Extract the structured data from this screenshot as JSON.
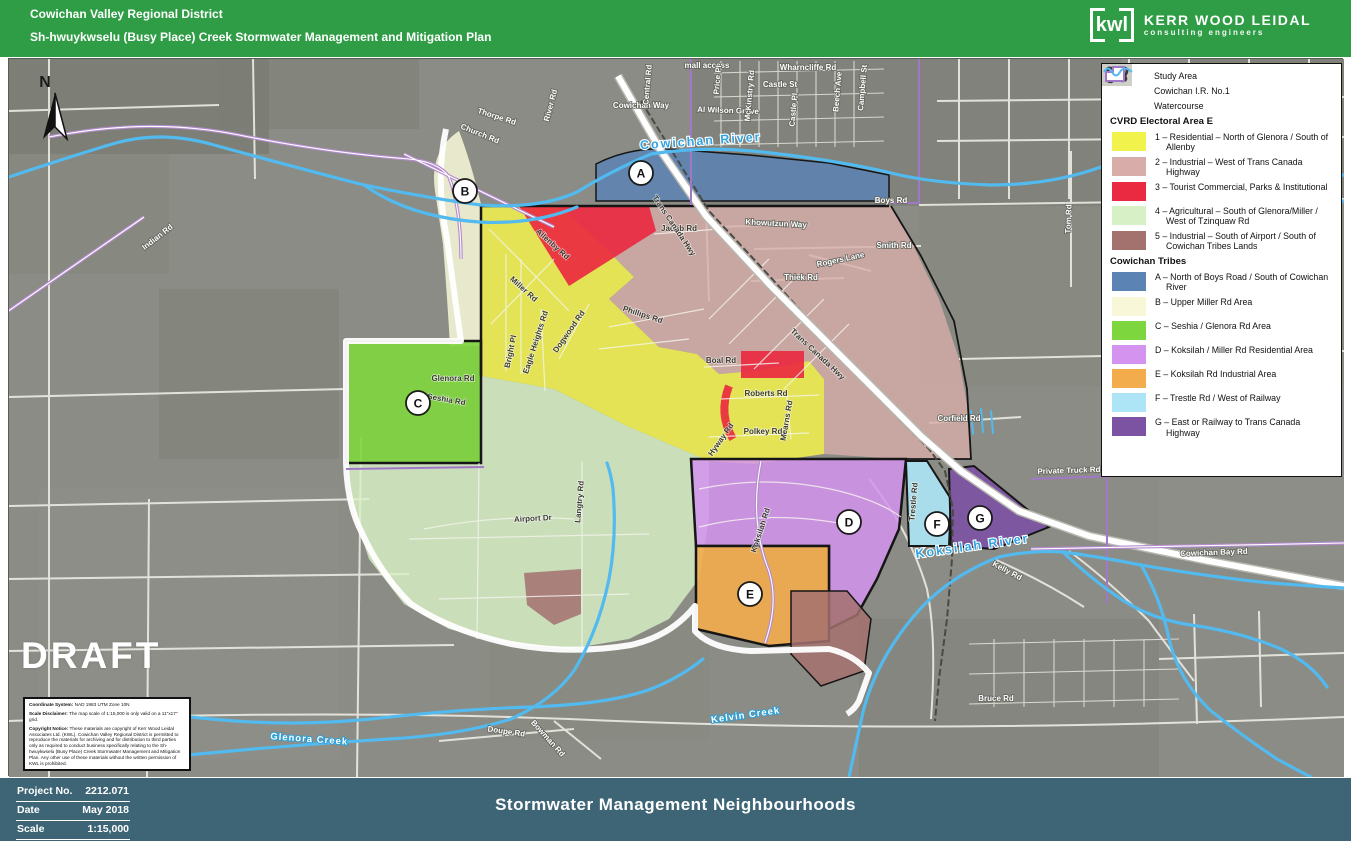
{
  "colors": {
    "header_green": "#2F9D45",
    "footer_slate": "#3D6576",
    "map_bg": "#8B8C85",
    "water": "#52BAEF",
    "road_white": "#F2F2EC",
    "ir_purple": "#A178C8",
    "study_outline": "#161616"
  },
  "header": {
    "org": "Cowichan Valley Regional District",
    "plan": "Sh-hwuykwselu (Busy Place) Creek Stormwater Management and Mitigation Plan",
    "logo": {
      "abbr": "kwl",
      "name": "KERR WOOD LEIDAL",
      "tagline": "consulting engineers"
    }
  },
  "legend": {
    "items": [
      {
        "icon": "study-area",
        "label": "Study Area"
      },
      {
        "icon": "ir-boundary",
        "label": "Cowichan I.R. No.1"
      },
      {
        "icon": "watercourse",
        "label": "Watercourse"
      }
    ],
    "cvrd": {
      "header": "CVRD Electoral Area E",
      "items": [
        {
          "label": "1 – Residential – North of Glenora / South of Allenby",
          "color": "#F2F24C"
        },
        {
          "label": "2 – Industrial – West of Trans Canada Highway",
          "color": "#D7ACA9"
        },
        {
          "label": "3 – Tourist Commercial, Parks & Institutional",
          "color": "#EA2A40"
        },
        {
          "label": "4 – Agricultural – South of Glenora/Miller / West of Tzinquaw Rd",
          "color": "#D8F0C6"
        },
        {
          "label": "5 – Industrial – South of Airport / South of Cowichan Tribes Lands",
          "color": "#A3716E"
        }
      ]
    },
    "tribes": {
      "header": "Cowichan Tribes",
      "items": [
        {
          "label": "A – North of Boys Road / South of Cowichan River",
          "color": "#5B83B4"
        },
        {
          "label": "B – Upper Miller Rd Area",
          "color": "#F8F8D8"
        },
        {
          "label": "C – Seshia / Glenora Rd Area",
          "color": "#7ED63E"
        },
        {
          "label": "D – Koksilah / Miller Rd Residential Area",
          "color": "#D493EE"
        },
        {
          "label": "E – Koksilah Rd Industrial Area",
          "color": "#F2AC4C"
        },
        {
          "label": "F – Trestle Rd / West of Railway",
          "color": "#ADE5F7"
        },
        {
          "label": "G – East or Railway to Trans Canada Highway",
          "color": "#7C52A3"
        }
      ]
    }
  },
  "map": {
    "draft": "DRAFT",
    "north": "N",
    "labels": [
      {
        "t": "Indian Rd",
        "x": 150,
        "y": 180,
        "r": -38,
        "k": "rl"
      },
      {
        "t": "Thorpe Rd",
        "x": 487,
        "y": 60,
        "r": 18,
        "k": "rl"
      },
      {
        "t": "Church Rd",
        "x": 470,
        "y": 77,
        "r": 22,
        "k": "rl"
      },
      {
        "t": "River Rd",
        "x": 544,
        "y": 47,
        "r": -75,
        "k": "rl"
      },
      {
        "t": "Cowichan Way",
        "x": 632,
        "y": 49,
        "r": 0,
        "k": "rl"
      },
      {
        "t": "Al Wilson Grove",
        "x": 719,
        "y": 54,
        "r": 2,
        "k": "rl"
      },
      {
        "t": "mall access",
        "x": 698,
        "y": 9,
        "r": 0,
        "k": "rl"
      },
      {
        "t": "Central Rd",
        "x": 641,
        "y": 26,
        "r": -85,
        "k": "rl"
      },
      {
        "t": "Price Pl",
        "x": 711,
        "y": 21,
        "r": -85,
        "k": "rl"
      },
      {
        "t": "McKinstry Rd",
        "x": 743,
        "y": 37,
        "r": -85,
        "k": "rl"
      },
      {
        "t": "Wharncliffe Rd",
        "x": 799,
        "y": 11,
        "r": 0,
        "k": "rl"
      },
      {
        "t": "Castle St",
        "x": 771,
        "y": 28,
        "r": 0,
        "k": "rl"
      },
      {
        "t": "Castle Pl",
        "x": 787,
        "y": 51,
        "r": -85,
        "k": "rl"
      },
      {
        "t": "Beech Ave",
        "x": 831,
        "y": 33,
        "r": -85,
        "k": "rl"
      },
      {
        "t": "Campbell St",
        "x": 856,
        "y": 29,
        "r": -85,
        "k": "rl"
      },
      {
        "t": "Cowichan River",
        "x": 692,
        "y": 86,
        "r": -4,
        "k": "wb"
      },
      {
        "t": "Boys Rd",
        "x": 882,
        "y": 144,
        "r": 0,
        "k": "rl"
      },
      {
        "t": "Khowutzun Way",
        "x": 767,
        "y": 167,
        "r": 3,
        "k": "rl"
      },
      {
        "t": "Smith Rd",
        "x": 885,
        "y": 189,
        "r": 0,
        "k": "rl"
      },
      {
        "t": "Rogers Lane",
        "x": 832,
        "y": 203,
        "r": -12,
        "k": "rl"
      },
      {
        "t": "Thiek Rd",
        "x": 792,
        "y": 221,
        "r": 0,
        "k": "rl"
      },
      {
        "t": "Tom Rd",
        "x": 1062,
        "y": 160,
        "r": -88,
        "k": "rl"
      },
      {
        "t": "Jacob Rd",
        "x": 670,
        "y": 172,
        "r": 0,
        "k": "rd"
      },
      {
        "t": "Allenby Rd",
        "x": 542,
        "y": 187,
        "r": 42,
        "k": "rd"
      },
      {
        "t": "Miller Rd",
        "x": 513,
        "y": 232,
        "r": 42,
        "k": "rd"
      },
      {
        "t": "Eagle Heights Rd",
        "x": 529,
        "y": 284,
        "r": -72,
        "k": "rd"
      },
      {
        "t": "Dogwood Rd",
        "x": 562,
        "y": 274,
        "r": -55,
        "k": "rd"
      },
      {
        "t": "Phillips Rd",
        "x": 633,
        "y": 258,
        "r": 18,
        "k": "rd"
      },
      {
        "t": "Bright Pl",
        "x": 504,
        "y": 293,
        "r": -78,
        "k": "rd"
      },
      {
        "t": "Boal Rd",
        "x": 712,
        "y": 304,
        "r": 0,
        "k": "rd"
      },
      {
        "t": "Roberts Rd",
        "x": 757,
        "y": 337,
        "r": 0,
        "k": "rd"
      },
      {
        "t": "Polkey Rd",
        "x": 754,
        "y": 375,
        "r": 0,
        "k": "rd"
      },
      {
        "t": "Mearns Rd",
        "x": 780,
        "y": 362,
        "r": -80,
        "k": "rd"
      },
      {
        "t": "Hyway Rd",
        "x": 714,
        "y": 382,
        "r": -55,
        "k": "rd"
      },
      {
        "t": "Trans Canada Hwy",
        "x": 807,
        "y": 297,
        "r": 43,
        "k": "rd"
      },
      {
        "t": "Trans Canada Hwy",
        "x": 663,
        "y": 168,
        "r": 56,
        "k": "rd"
      },
      {
        "t": "Corfield Rd",
        "x": 950,
        "y": 362,
        "r": 0,
        "k": "rl"
      },
      {
        "t": "Glenora Rd",
        "x": 444,
        "y": 322,
        "r": 0,
        "k": "rd"
      },
      {
        "t": "Seshia Rd",
        "x": 437,
        "y": 343,
        "r": 10,
        "k": "rd"
      },
      {
        "t": "Koksilah Rd",
        "x": 754,
        "y": 472,
        "r": -72,
        "k": "rd"
      },
      {
        "t": "Koksilah River",
        "x": 964,
        "y": 491,
        "r": -8,
        "k": "wb"
      },
      {
        "t": "Kelly Rd",
        "x": 997,
        "y": 514,
        "r": 28,
        "k": "rl"
      },
      {
        "t": "Trestle Rd",
        "x": 907,
        "y": 443,
        "r": -85,
        "k": "rd"
      },
      {
        "t": "Private Truck Rd",
        "x": 1060,
        "y": 414,
        "r": -2,
        "k": "rl"
      },
      {
        "t": "Cowichan Bay Rd",
        "x": 1205,
        "y": 496,
        "r": -2,
        "k": "rl"
      },
      {
        "t": "Glenora Creek",
        "x": 300,
        "y": 683,
        "r": 4,
        "k": "wc"
      },
      {
        "t": "Kelvin Creek",
        "x": 737,
        "y": 659,
        "r": -8,
        "k": "wc"
      },
      {
        "t": "Doupe Rd",
        "x": 497,
        "y": 675,
        "r": 8,
        "k": "rl"
      },
      {
        "t": "Bowman Rd",
        "x": 537,
        "y": 681,
        "r": 48,
        "k": "rl"
      },
      {
        "t": "Bruce Rd",
        "x": 987,
        "y": 642,
        "r": 0,
        "k": "rl"
      },
      {
        "t": "Airport Dr",
        "x": 524,
        "y": 462,
        "r": -3,
        "k": "rd"
      },
      {
        "t": "Langtry Rd",
        "x": 573,
        "y": 443,
        "r": -85,
        "k": "rd"
      }
    ],
    "markers": [
      {
        "t": "A",
        "x": 632,
        "y": 114
      },
      {
        "t": "B",
        "x": 456,
        "y": 132
      },
      {
        "t": "C",
        "x": 409,
        "y": 344
      },
      {
        "t": "D",
        "x": 840,
        "y": 463
      },
      {
        "t": "E",
        "x": 741,
        "y": 535
      },
      {
        "t": "F",
        "x": 928,
        "y": 465
      },
      {
        "t": "G",
        "x": 971,
        "y": 459
      }
    ]
  },
  "notes": {
    "coordinate_system": {
      "label": "Coordinate System:",
      "text": "NAD 1983 UTM Zone 10N"
    },
    "scale_disclaimer": {
      "label": "Scale Disclaimer:",
      "text": "The map scale of 1:15,000 is only valid on a 11\"x17\" grid."
    },
    "copyright_notice": {
      "label": "Copyright Notice:",
      "text": "These materials are copyright of Kerr Wood Leidal Associates Ltd. (KWL). Cowichan Valley Regional District is permitted to reproduce the materials for archiving and for distribution to third parties only as required to conduct business specifically relating to the Sh-hwuykwselu (Busy Place) Creek Stormwater Management and Mitigation Plan. Any other use of these materials without the written permission of KWL is prohibited."
    }
  },
  "footer": {
    "project_no_label": "Project No.",
    "project_no": "2212.071",
    "date_label": "Date",
    "date": "May 2018",
    "scale_label": "Scale",
    "scale": "1:15,000",
    "title": "Stormwater Management Neighbourhoods"
  }
}
